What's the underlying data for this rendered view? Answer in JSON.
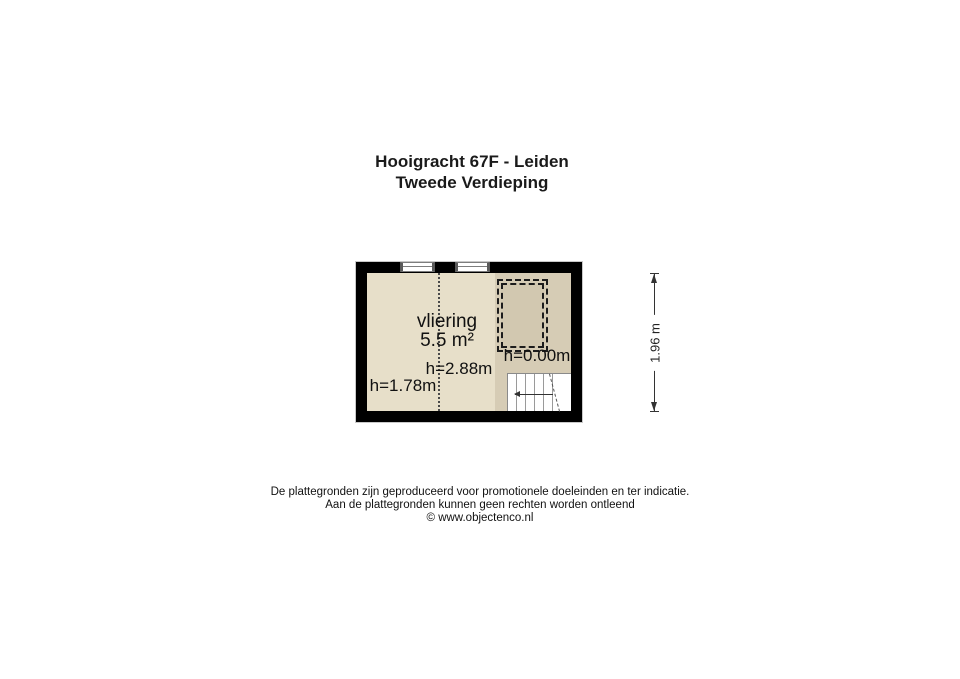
{
  "title": {
    "line1": "Hooigracht 67F - Leiden",
    "line2": "Tweede Verdieping"
  },
  "floorplan": {
    "room_label": "vliering",
    "room_area": "5.5 m²",
    "height_center": "h=2.88m",
    "height_left": "h=1.78m",
    "height_right": "h=0.00m",
    "dimension_label": "1.96 m",
    "colors": {
      "wall": "#000000",
      "floor_light": "#e7dfc9",
      "floor_dark": "#d6ccb5",
      "hatch_fill": "#d2c8b0",
      "line": "#333333"
    }
  },
  "footer": {
    "line1": "De plattegronden zijn geproduceerd voor promotionele doeleinden en ter indicatie.",
    "line2": "Aan de plattegronden kunnen geen rechten worden ontleend",
    "line3": "© www.objectenco.nl"
  }
}
